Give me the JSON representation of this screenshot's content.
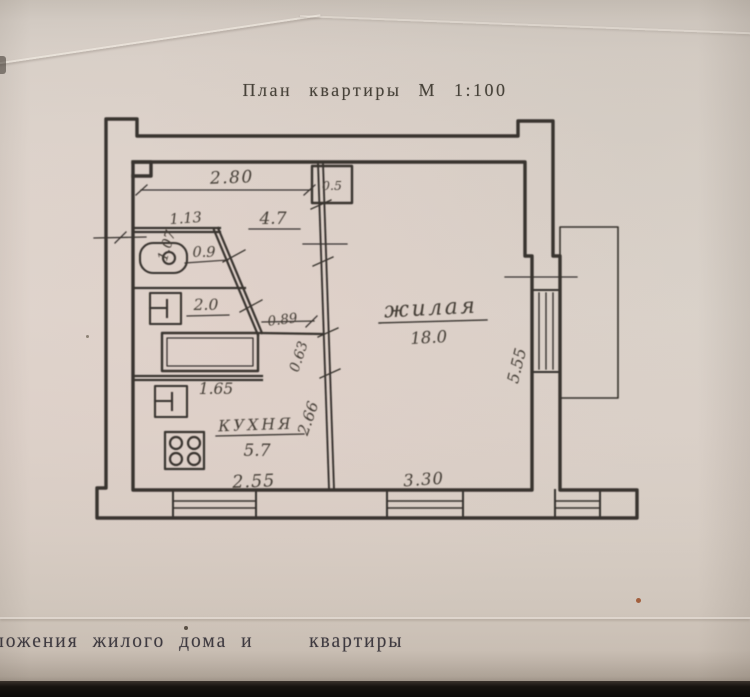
{
  "title": "План квартиры М 1:100",
  "footer": "ложения жилого дома и    квартиры",
  "colors": {
    "paper": "#dcd4cc",
    "ink": "#2b2724"
  },
  "plan": {
    "scale": "1:100",
    "rooms": {
      "living": {
        "name": "жилая",
        "area": "18.0"
      },
      "kitchen": {
        "name": "КУХНЯ",
        "area": "5.7"
      },
      "hall": {
        "area": "4.7"
      },
      "wc": {
        "area": "0.9"
      },
      "bathroom": {
        "area": "2.0"
      }
    },
    "dims": {
      "hall_width": "2.80",
      "niche": "0.5",
      "entry": "1.07",
      "wc_width": "1.13",
      "passage_width": "0.89",
      "passage_length": "0.63",
      "bathtub_length": "1.65",
      "kitchen_depth": "2.66",
      "kitchen_width": "2.55",
      "living_width": "3.30",
      "living_depth": "5.55"
    }
  }
}
